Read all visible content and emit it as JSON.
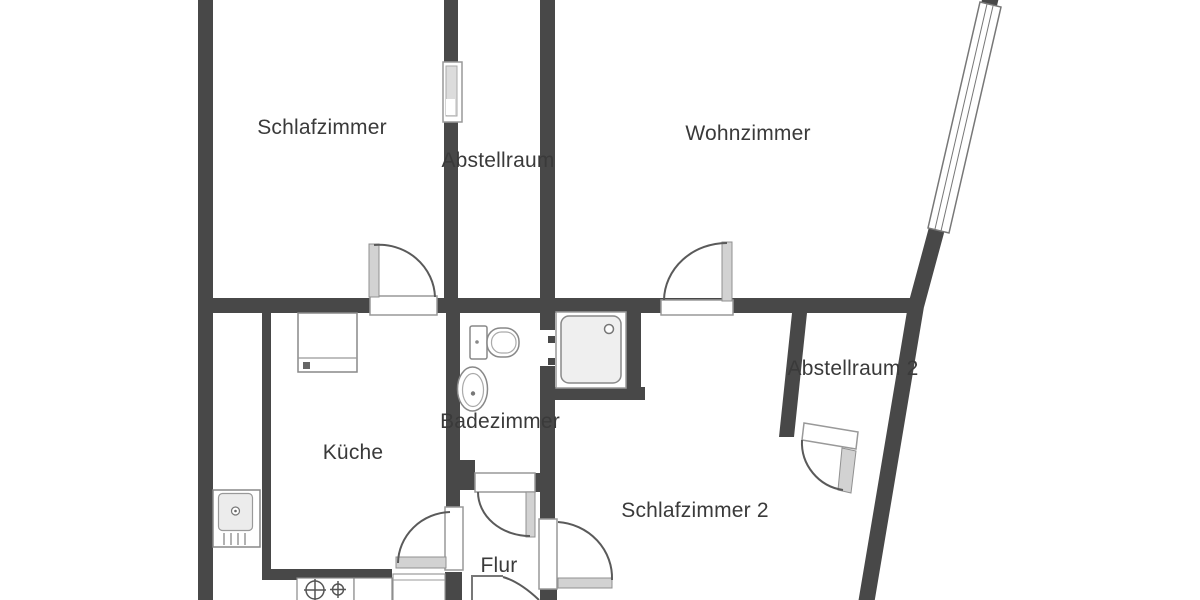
{
  "floor_plan": {
    "background_color": "#ffffff",
    "wall_color": "#484848",
    "label_color": "#3a3a3a",
    "door_arc_color": "#5a5a5a",
    "door_leaf_color": "#d2d2d2",
    "rooms": [
      {
        "id": "schlafzimmer",
        "label": "Schlafzimmer"
      },
      {
        "id": "abstellraum",
        "label": "Abstellraum"
      },
      {
        "id": "wohnzimmer",
        "label": "Wohnzimmer"
      },
      {
        "id": "abstellraum-2",
        "label": "Abstellraum 2"
      },
      {
        "id": "badezimmer",
        "label": "Badezimmer"
      },
      {
        "id": "kueche",
        "label": "Küche"
      },
      {
        "id": "schlafzimmer-2",
        "label": "Schlafzimmer 2"
      },
      {
        "id": "flur",
        "label": "Flur"
      }
    ],
    "fixtures": [
      "shower",
      "toilet",
      "washbasin",
      "kitchen-sink",
      "kitchen-counter",
      "stove-burners",
      "diagonal-window",
      "small-wall-window"
    ],
    "doors": [
      "door-schlafzimmer",
      "door-wohnzimmer",
      "door-badezimmer",
      "door-kueche",
      "door-schlafzimmer-2",
      "door-abstellraum-2",
      "door-entrance",
      "shower-opening"
    ]
  }
}
